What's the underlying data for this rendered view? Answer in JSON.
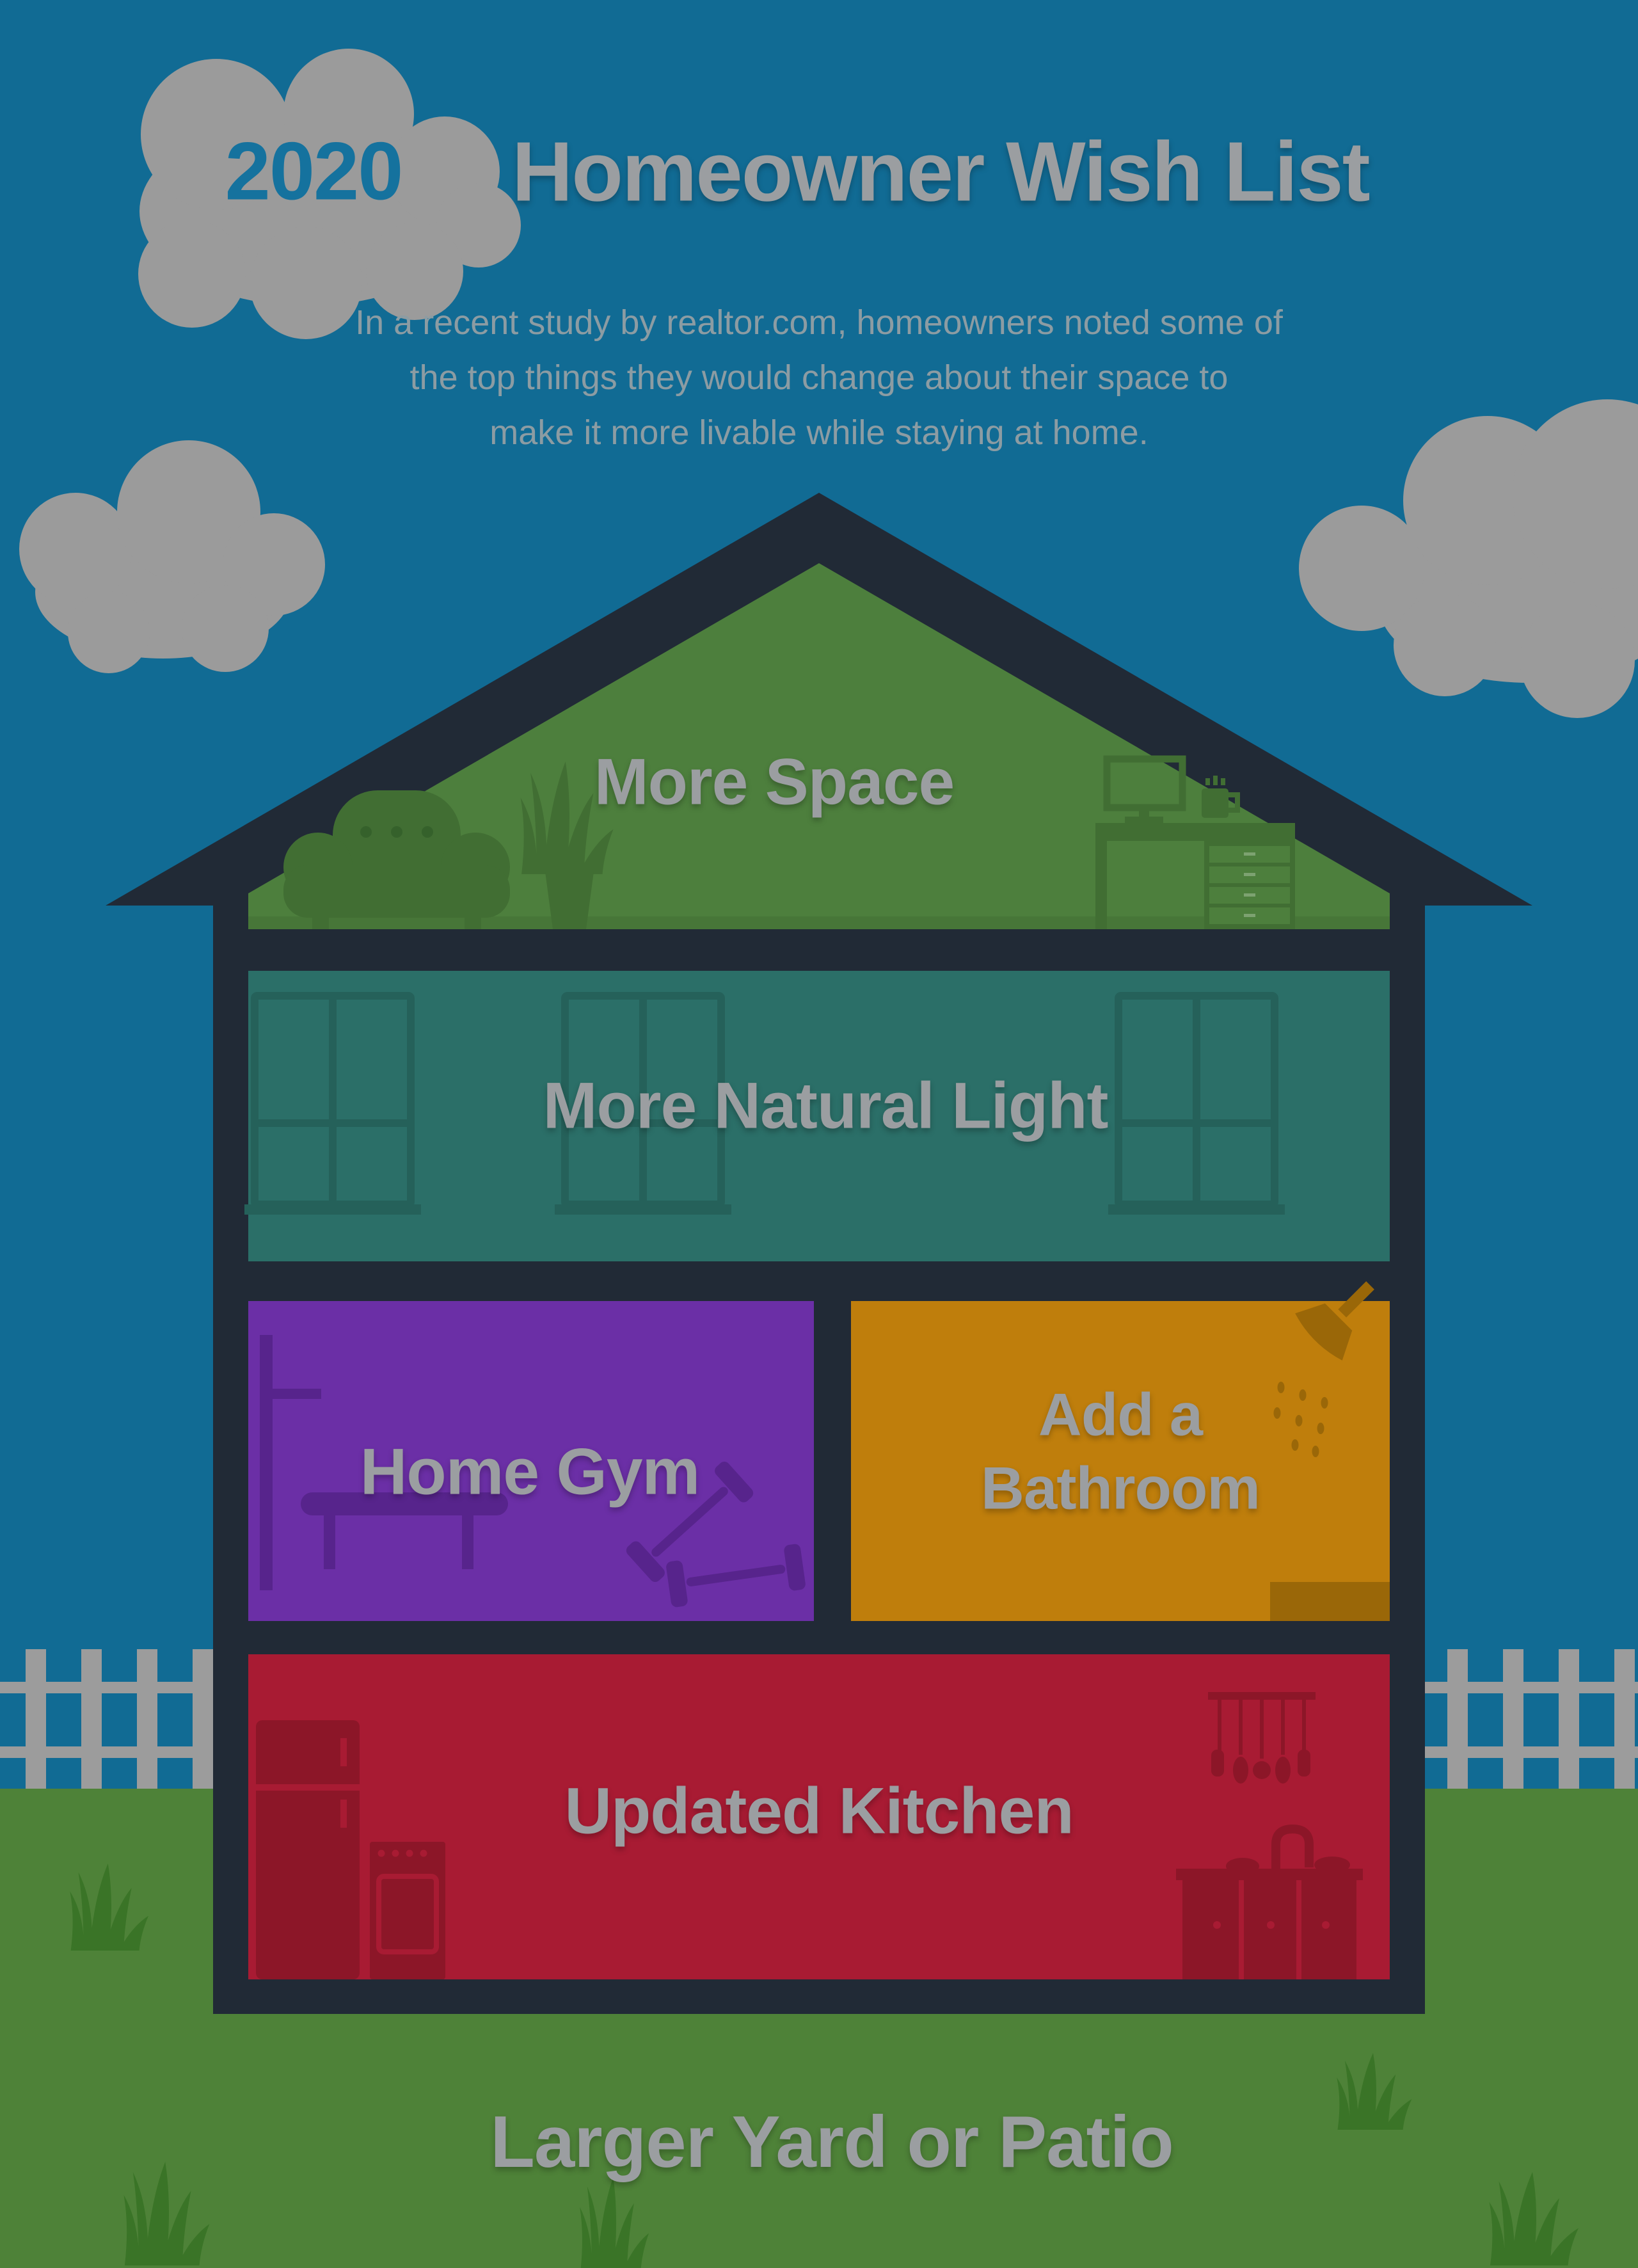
{
  "header": {
    "year_badge": "2020",
    "title": "Homeowner Wish List",
    "subtitle_lines": [
      "In a recent study by realtor.com, homeowners noted some of",
      "the top things they would change about their space to",
      "make it more livable while staying at home."
    ]
  },
  "house": {
    "attic": {
      "label": "More Space",
      "color": "#4d7f3d"
    },
    "living": {
      "label": "More Natural Light",
      "color": "#2b6f68"
    },
    "gym": {
      "label": "Home Gym",
      "color": "#6b2fa6"
    },
    "bathroom": {
      "label_lines": [
        "Add a",
        "Bathroom"
      ],
      "color": "#bf7e0c"
    },
    "kitchen": {
      "label": "Updated Kitchen",
      "color": "#a81b33"
    }
  },
  "yard": {
    "label": "Larger Yard or Patio",
    "grass_color": "#4e8238"
  },
  "palette": {
    "sky": "#116b94",
    "cloud_gray": "#9b9b9b",
    "text_gray": "#9b9ea1",
    "subtitle_gray": "#8c9ca3",
    "frame_dark": "#212a36",
    "fence_gray": "#9c9c9c",
    "grass_tuft_green": "#3a7427",
    "year_blue": "#15729e"
  }
}
